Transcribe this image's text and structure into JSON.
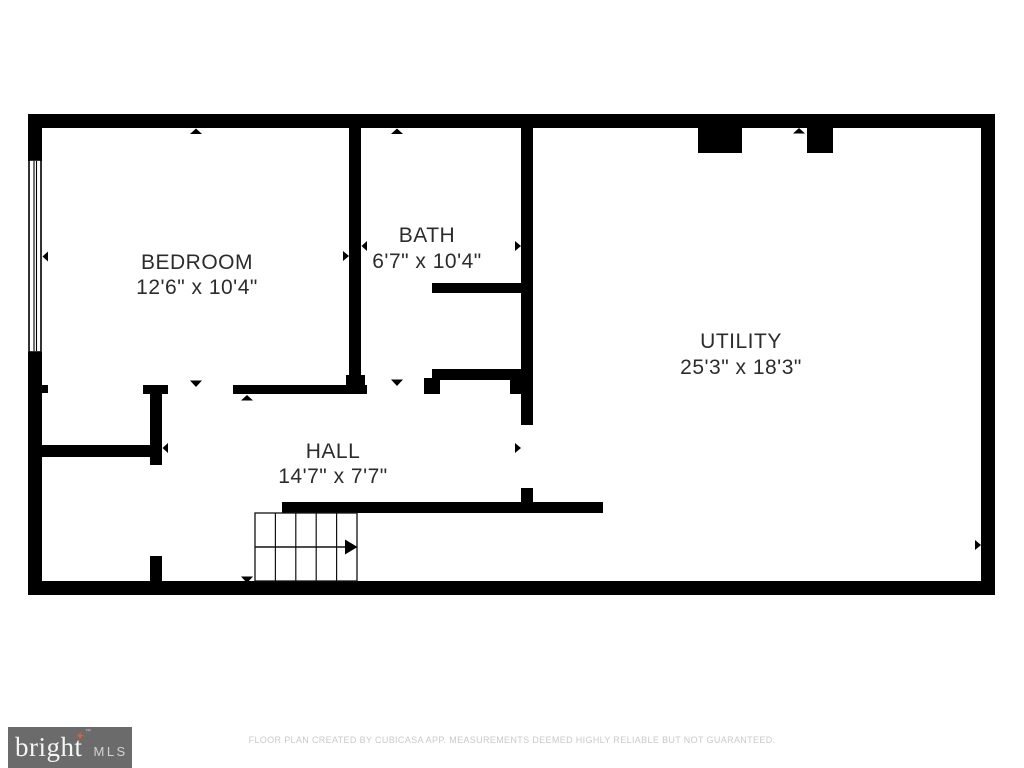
{
  "colors": {
    "wall": "#000000",
    "label": "#2c2c2c",
    "background": "#ffffff",
    "logo_bg": "#6b6b6b",
    "logo_text": "#f5f5f3",
    "logo_mls_text": "#d2d2d0",
    "logo_star": "#d9602f",
    "disclaimer_text": "#c9c9c9"
  },
  "rooms": {
    "bedroom": {
      "name": "BEDROOM",
      "dimensions": "12'6\" x 10'4\""
    },
    "bath": {
      "name": "BATH",
      "dimensions": "6'7\" x 10'4\""
    },
    "utility": {
      "name": "UTILITY",
      "dimensions": "25'3\" x 18'3\""
    },
    "hall": {
      "name": "HALL",
      "dimensions": "14'7\" x 7'7\""
    }
  },
  "branding": {
    "name": "bright",
    "suffix": "MLS",
    "trademark": "™",
    "star": "✦"
  },
  "footer": {
    "disclaimer": "FLOOR PLAN CREATED BY CUBICASA APP. MEASUREMENTS DEEMED HIGHLY RELIABLE BUT NOT GUARANTEED."
  }
}
